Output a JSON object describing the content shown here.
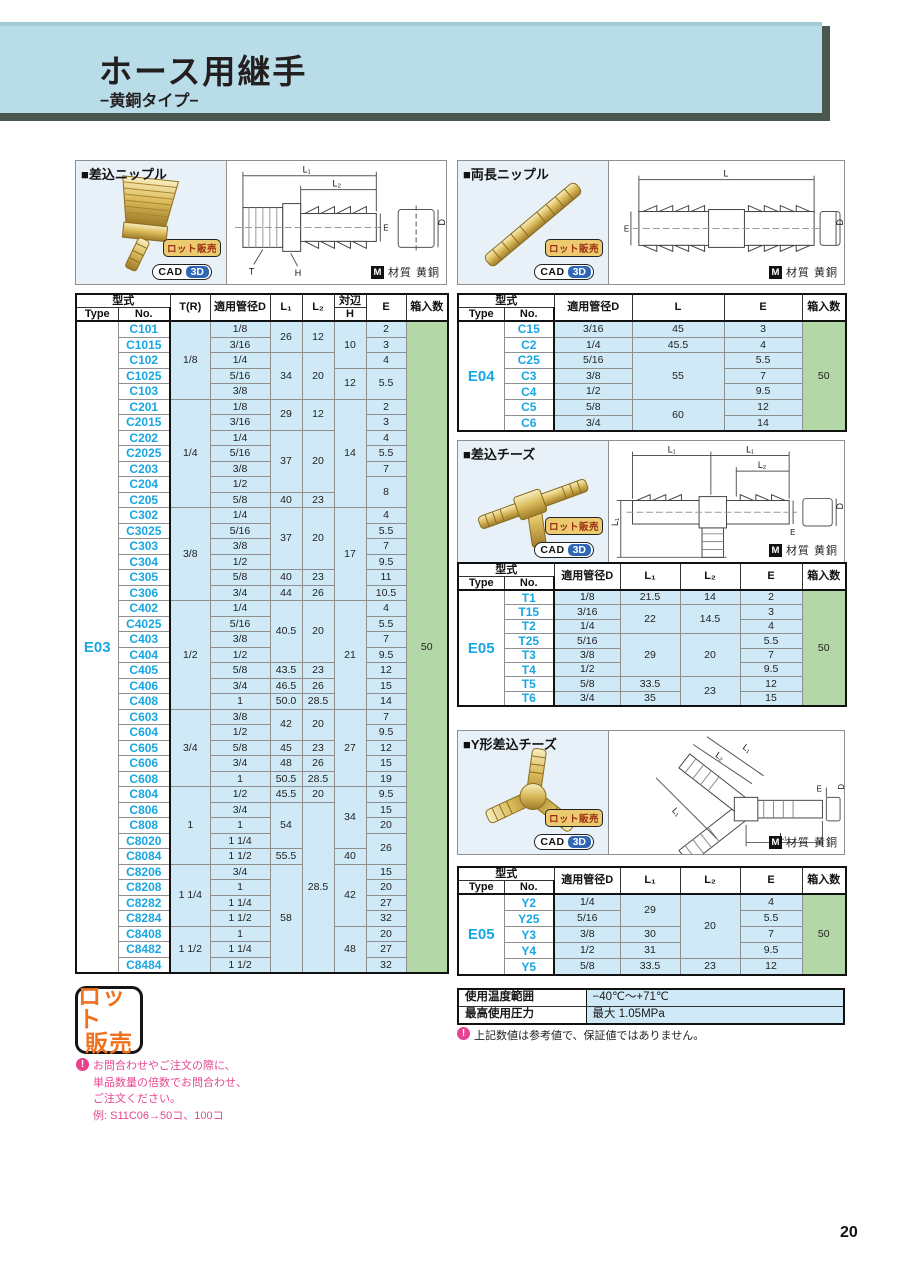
{
  "header": {
    "title": "ホース用継手",
    "subtitle": "−黄銅タイプ−"
  },
  "page_number": "20",
  "badges": {
    "lot": "ロット販売",
    "cad": "CAD",
    "cad_3d": "3D",
    "material_icon": "M",
    "material_label": "材質 黄銅",
    "lot_stamp_line1": "ロット",
    "lot_stamp_line2": "販売"
  },
  "panels": {
    "p1": {
      "title": "■差込ニップル"
    },
    "p2": {
      "title": "■両長ニップル"
    },
    "p3": {
      "title": "■差込チーズ"
    },
    "p4": {
      "title": "■Y形差込チーズ"
    }
  },
  "drawings": {
    "p1": {
      "l1": "L₁",
      "l2": "L₂",
      "d": "D",
      "e": "E",
      "t": "T",
      "h": "H"
    },
    "p2": {
      "l": "L",
      "e": "E",
      "d": "D"
    },
    "p3": {
      "l1a": "L₁",
      "l1b": "L₁",
      "l2": "L₂",
      "l1v": "L₁",
      "e": "E",
      "d": "D"
    },
    "p4": {
      "l2": "L₂",
      "l1a": "L₁",
      "l1b": "L₁",
      "l1c": "L₁",
      "e": "E",
      "d": "D"
    }
  },
  "labels": {
    "katashiki": "型式",
    "type": "Type",
    "no": "No.",
    "tr": "T(R)",
    "d": "適用管径D",
    "l1": "L₁",
    "l2": "L₂",
    "l": "L",
    "taihen": "対辺",
    "h": "H",
    "e": "E",
    "hako": "箱入数"
  },
  "tables": {
    "e03": {
      "cols": [
        "type",
        "no",
        "tr",
        "d",
        "l1",
        "l2",
        "h",
        "e",
        "hako"
      ],
      "rows": [
        [
          [
            "E03",
            42
          ],
          "C101",
          [
            "1/8",
            5
          ],
          "1/8",
          [
            "26",
            2
          ],
          [
            "12",
            2
          ],
          [
            "10",
            3
          ],
          "2",
          [
            "50",
            42
          ]
        ],
        [
          null,
          "C1015",
          null,
          "3/16",
          null,
          null,
          null,
          "3",
          null
        ],
        [
          null,
          "C102",
          null,
          "1/4",
          [
            "34",
            3
          ],
          [
            "20",
            3
          ],
          null,
          "4",
          null
        ],
        [
          null,
          "C1025",
          null,
          "5/16",
          null,
          null,
          [
            "12",
            2
          ],
          [
            "5.5",
            2
          ],
          null
        ],
        [
          null,
          "C103",
          null,
          "3/8",
          null,
          null,
          null,
          null,
          null
        ],
        [
          null,
          "C201",
          [
            "1/4",
            7
          ],
          "1/8",
          [
            "29",
            2
          ],
          [
            "12",
            2
          ],
          [
            "14",
            7
          ],
          "2",
          null
        ],
        [
          null,
          "C2015",
          null,
          "3/16",
          null,
          null,
          null,
          "3",
          null
        ],
        [
          null,
          "C202",
          null,
          "1/4",
          [
            "37",
            4
          ],
          [
            "20",
            4
          ],
          null,
          "4",
          null
        ],
        [
          null,
          "C2025",
          null,
          "5/16",
          null,
          null,
          null,
          "5.5",
          null
        ],
        [
          null,
          "C203",
          null,
          "3/8",
          null,
          null,
          null,
          "7",
          null
        ],
        [
          null,
          "C204",
          null,
          "1/2",
          null,
          null,
          null,
          [
            "8",
            2
          ],
          null
        ],
        [
          null,
          "C205",
          null,
          "5/8",
          "40",
          "23",
          null,
          null,
          null
        ],
        [
          null,
          "C302",
          [
            "3/8",
            6
          ],
          "1/4",
          [
            "37",
            4
          ],
          [
            "20",
            4
          ],
          [
            "17",
            6
          ],
          "4",
          null
        ],
        [
          null,
          "C3025",
          null,
          "5/16",
          null,
          null,
          null,
          "5.5",
          null
        ],
        [
          null,
          "C303",
          null,
          "3/8",
          null,
          null,
          null,
          "7",
          null
        ],
        [
          null,
          "C304",
          null,
          "1/2",
          null,
          null,
          null,
          "9.5",
          null
        ],
        [
          null,
          "C305",
          null,
          "5/8",
          "40",
          "23",
          null,
          "11",
          null
        ],
        [
          null,
          "C306",
          null,
          "3/4",
          "44",
          "26",
          null,
          "10.5",
          null
        ],
        [
          null,
          "C402",
          [
            "1/2",
            7
          ],
          "1/4",
          [
            "40.5",
            4
          ],
          [
            "20",
            4
          ],
          [
            "21",
            7
          ],
          "4",
          null
        ],
        [
          null,
          "C4025",
          null,
          "5/16",
          null,
          null,
          null,
          "5.5",
          null
        ],
        [
          null,
          "C403",
          null,
          "3/8",
          null,
          null,
          null,
          "7",
          null
        ],
        [
          null,
          "C404",
          null,
          "1/2",
          null,
          null,
          null,
          "9.5",
          null
        ],
        [
          null,
          "C405",
          null,
          "5/8",
          "43.5",
          "23",
          null,
          "12",
          null
        ],
        [
          null,
          "C406",
          null,
          "3/4",
          "46.5",
          "26",
          null,
          "15",
          null
        ],
        [
          null,
          "C408",
          null,
          "1",
          "50.0",
          "28.5",
          null,
          "14",
          null
        ],
        [
          null,
          "C603",
          [
            "3/4",
            5
          ],
          "3/8",
          [
            "42",
            2
          ],
          [
            "20",
            2
          ],
          [
            "27",
            5
          ],
          "7",
          null
        ],
        [
          null,
          "C604",
          null,
          "1/2",
          null,
          null,
          null,
          "9.5",
          null
        ],
        [
          null,
          "C605",
          null,
          "5/8",
          "45",
          "23",
          null,
          "12",
          null
        ],
        [
          null,
          "C606",
          null,
          "3/4",
          "48",
          "26",
          null,
          "15",
          null
        ],
        [
          null,
          "C608",
          null,
          "1",
          "50.5",
          "28.5",
          null,
          "19",
          null
        ],
        [
          null,
          "C804",
          [
            "1",
            5
          ],
          "1/2",
          "45.5",
          "20",
          [
            "34",
            4
          ],
          "9.5",
          null
        ],
        [
          null,
          "C806",
          null,
          "3/4",
          [
            "54",
            3
          ],
          [
            "28.5",
            11
          ],
          null,
          "15",
          null
        ],
        [
          null,
          "C808",
          null,
          "1",
          null,
          null,
          null,
          "20",
          null
        ],
        [
          null,
          "C8020",
          null,
          "1 1/4",
          null,
          null,
          null,
          [
            "26",
            2
          ],
          null
        ],
        [
          null,
          "C8084",
          null,
          "1 1/2",
          "55.5",
          null,
          "40",
          null,
          null
        ],
        [
          null,
          "C8206",
          [
            "1 1/4",
            4
          ],
          "3/4",
          [
            "58",
            7
          ],
          null,
          [
            "42",
            4
          ],
          "15",
          null
        ],
        [
          null,
          "C8208",
          null,
          "1",
          null,
          null,
          null,
          "20",
          null
        ],
        [
          null,
          "C8282",
          null,
          "1 1/4",
          null,
          null,
          null,
          "27",
          null
        ],
        [
          null,
          "C8284",
          null,
          "1 1/2",
          null,
          null,
          null,
          "32",
          null
        ],
        [
          null,
          "C8408",
          [
            "1 1/2",
            3
          ],
          "1",
          null,
          null,
          [
            "48",
            3
          ],
          "20",
          null
        ],
        [
          null,
          "C8482",
          null,
          "1 1/4",
          null,
          null,
          null,
          "27",
          null
        ],
        [
          null,
          "C8484",
          null,
          "1 1/2",
          null,
          null,
          null,
          "32",
          null
        ]
      ]
    },
    "e04": {
      "cols": [
        "type",
        "no",
        "d",
        "l",
        "e",
        "hako"
      ],
      "rows": [
        [
          [
            "E04",
            7
          ],
          "C15",
          "3/16",
          "45",
          "3",
          [
            "50",
            7
          ]
        ],
        [
          null,
          "C2",
          "1/4",
          "45.5",
          "4",
          null
        ],
        [
          null,
          "C25",
          "5/16",
          [
            "55",
            3
          ],
          "5.5",
          null
        ],
        [
          null,
          "C3",
          "3/8",
          null,
          "7",
          null
        ],
        [
          null,
          "C4",
          "1/2",
          null,
          "9.5",
          null
        ],
        [
          null,
          "C5",
          "5/8",
          [
            "60",
            2
          ],
          "12",
          null
        ],
        [
          null,
          "C6",
          "3/4",
          null,
          "14",
          null
        ]
      ]
    },
    "e05t": {
      "cols": [
        "type",
        "no",
        "d",
        "l1",
        "l2",
        "e",
        "hako"
      ],
      "rows": [
        [
          [
            "E05",
            8
          ],
          "T1",
          "1/8",
          "21.5",
          "14",
          "2",
          [
            "50",
            8
          ]
        ],
        [
          null,
          "T15",
          "3/16",
          [
            "22",
            2
          ],
          [
            "14.5",
            2
          ],
          "3",
          null
        ],
        [
          null,
          "T2",
          "1/4",
          null,
          null,
          "4",
          null
        ],
        [
          null,
          "T25",
          "5/16",
          [
            "29",
            3
          ],
          [
            "20",
            3
          ],
          "5.5",
          null
        ],
        [
          null,
          "T3",
          "3/8",
          null,
          null,
          "7",
          null
        ],
        [
          null,
          "T4",
          "1/2",
          null,
          null,
          "9.5",
          null
        ],
        [
          null,
          "T5",
          "5/8",
          "33.5",
          [
            "23",
            2
          ],
          "12",
          null
        ],
        [
          null,
          "T6",
          "3/4",
          "35",
          null,
          "15",
          null
        ]
      ]
    },
    "e05y": {
      "cols": [
        "type",
        "no",
        "d",
        "l1",
        "l2",
        "e",
        "hako"
      ],
      "rows": [
        [
          [
            "E05",
            5
          ],
          "Y2",
          "1/4",
          [
            "29",
            2
          ],
          [
            "20",
            4
          ],
          "4",
          [
            "50",
            5
          ]
        ],
        [
          null,
          "Y25",
          "5/16",
          null,
          null,
          "5.5",
          null
        ],
        [
          null,
          "Y3",
          "3/8",
          "30",
          null,
          "7",
          null
        ],
        [
          null,
          "Y4",
          "1/2",
          "31",
          null,
          "9.5",
          null
        ],
        [
          null,
          "Y5",
          "5/8",
          "33.5",
          "23",
          "12",
          null
        ]
      ]
    }
  },
  "spec": {
    "rows": [
      [
        "使用温度範囲",
        "−40℃〜+71℃"
      ],
      [
        "最高使用圧力",
        "最大 1.05MPa"
      ]
    ],
    "note": "上記数値は参考値で、保証値ではありません。",
    "note_icon": "!"
  },
  "lot_note": {
    "icon": "!",
    "lines": [
      "お問合わせやご注文の際に、",
      "単品数量の倍数でお問合わせ、",
      "ご注文ください。",
      "例: S11C06→50コ、100コ"
    ]
  }
}
